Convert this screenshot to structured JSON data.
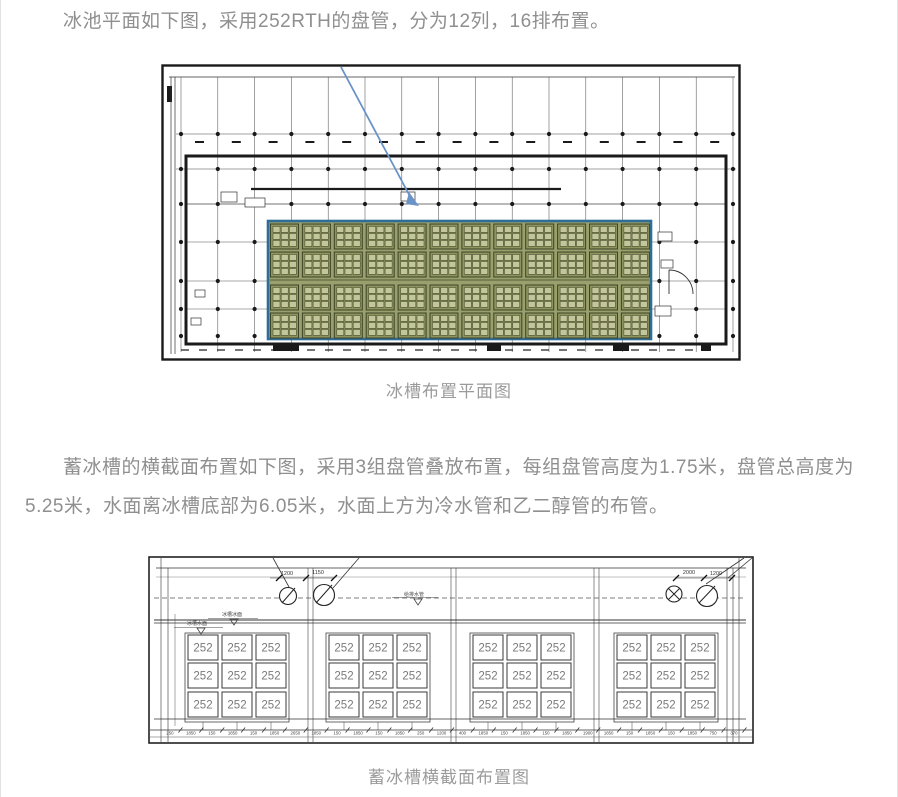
{
  "article": {
    "paragraph1": "冰池平面如下图，采用252RTH的盘管，分为12列，16排布置。",
    "paragraph2": "蓄冰槽的横截面布置如下图，采用3组盘管叠放布置，每组盘管高度为1.75米，盘管总高度为5.25米，水面离冰槽底部为6.05米，水面上方为冷水管和乙二醇管的布管。",
    "text_color": "#8f8f8f"
  },
  "figure1": {
    "caption": "冰槽布置平面图",
    "coil_grid": {
      "rows": 4,
      "cols": 12
    },
    "colors": {
      "highlight_fill": "#99a06d",
      "highlight_border": "#2f6d96",
      "group_fill": "#8e945f",
      "cell_fill": "#c3c59b",
      "line_dark": "#3e4426",
      "arrow": "#6b93c8",
      "ink": "#1a1a1a"
    }
  },
  "figure2": {
    "caption": "蓄冰槽横截面布置图",
    "coil_label": "252",
    "group_count": 4,
    "group_grid": {
      "rows": 3,
      "cols": 3
    },
    "pipe_dims_left": [
      "1200",
      "1150"
    ],
    "pipe_dims_right": [
      "2000",
      "1200"
    ],
    "level_labels": {
      "upper": "冰槽冰面",
      "lower": "冰槽水面",
      "mid": "给排水管"
    },
    "bottom_dims": [
      "250",
      "1850",
      "150",
      "1850",
      "150",
      "1850",
      "2650",
      "1850",
      "150",
      "1850",
      "150",
      "1850",
      "250",
      "1200",
      "400",
      "1850",
      "150",
      "1850",
      "150",
      "1850",
      "1900",
      "1850",
      "150",
      "1850",
      "150",
      "1850",
      "750",
      "370"
    ],
    "colors": {
      "ink": "#222222",
      "label": "#7a7a7a",
      "dim": "#444444"
    }
  }
}
